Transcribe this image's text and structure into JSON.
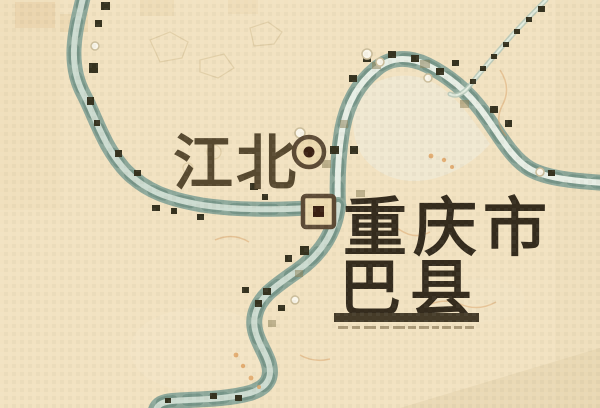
{
  "map": {
    "type": "historical-city-map",
    "labels": {
      "district_north": "江北",
      "city": "重庆市",
      "county": "巴县"
    },
    "symbols": [
      {
        "name": "town-ring-icon",
        "meaning": "town marker beside 江北",
        "shape": "circle-with-dark-core"
      },
      {
        "name": "city-seat-icon",
        "meaning": "city marker beside 重庆市",
        "shape": "square-with-dark-core"
      }
    ],
    "features": {
      "river_loop": "river enters top-left edge, loops around upper-right peninsula, joins at center and flows to bottom edge",
      "tributary": "thin stream from top-right corner joining main river",
      "county_underline": true,
      "microtext_row": "illegible fine print under 巴县 underline"
    },
    "colors": {
      "background": "#f2e2c1",
      "background_shade": "#e8d5ae",
      "river_outer": "#8da89a",
      "river_dark": "#709083",
      "river_inner": "#ccdbd0",
      "river_light": "#e7eee5",
      "peninsula_fill": "#efe9d6",
      "label_dark": "#342b1d",
      "label_soft": "#57492f",
      "underline": "#453b28",
      "marker_dark": "#35321f",
      "marker_khaki": "#8f855c",
      "symbol_fill": "#ecd9ae",
      "symbol_stroke": "#5c4a35",
      "symbol_core": "#3a2012",
      "contour": "#d9a36a",
      "microtext": "#9b8a68"
    }
  }
}
